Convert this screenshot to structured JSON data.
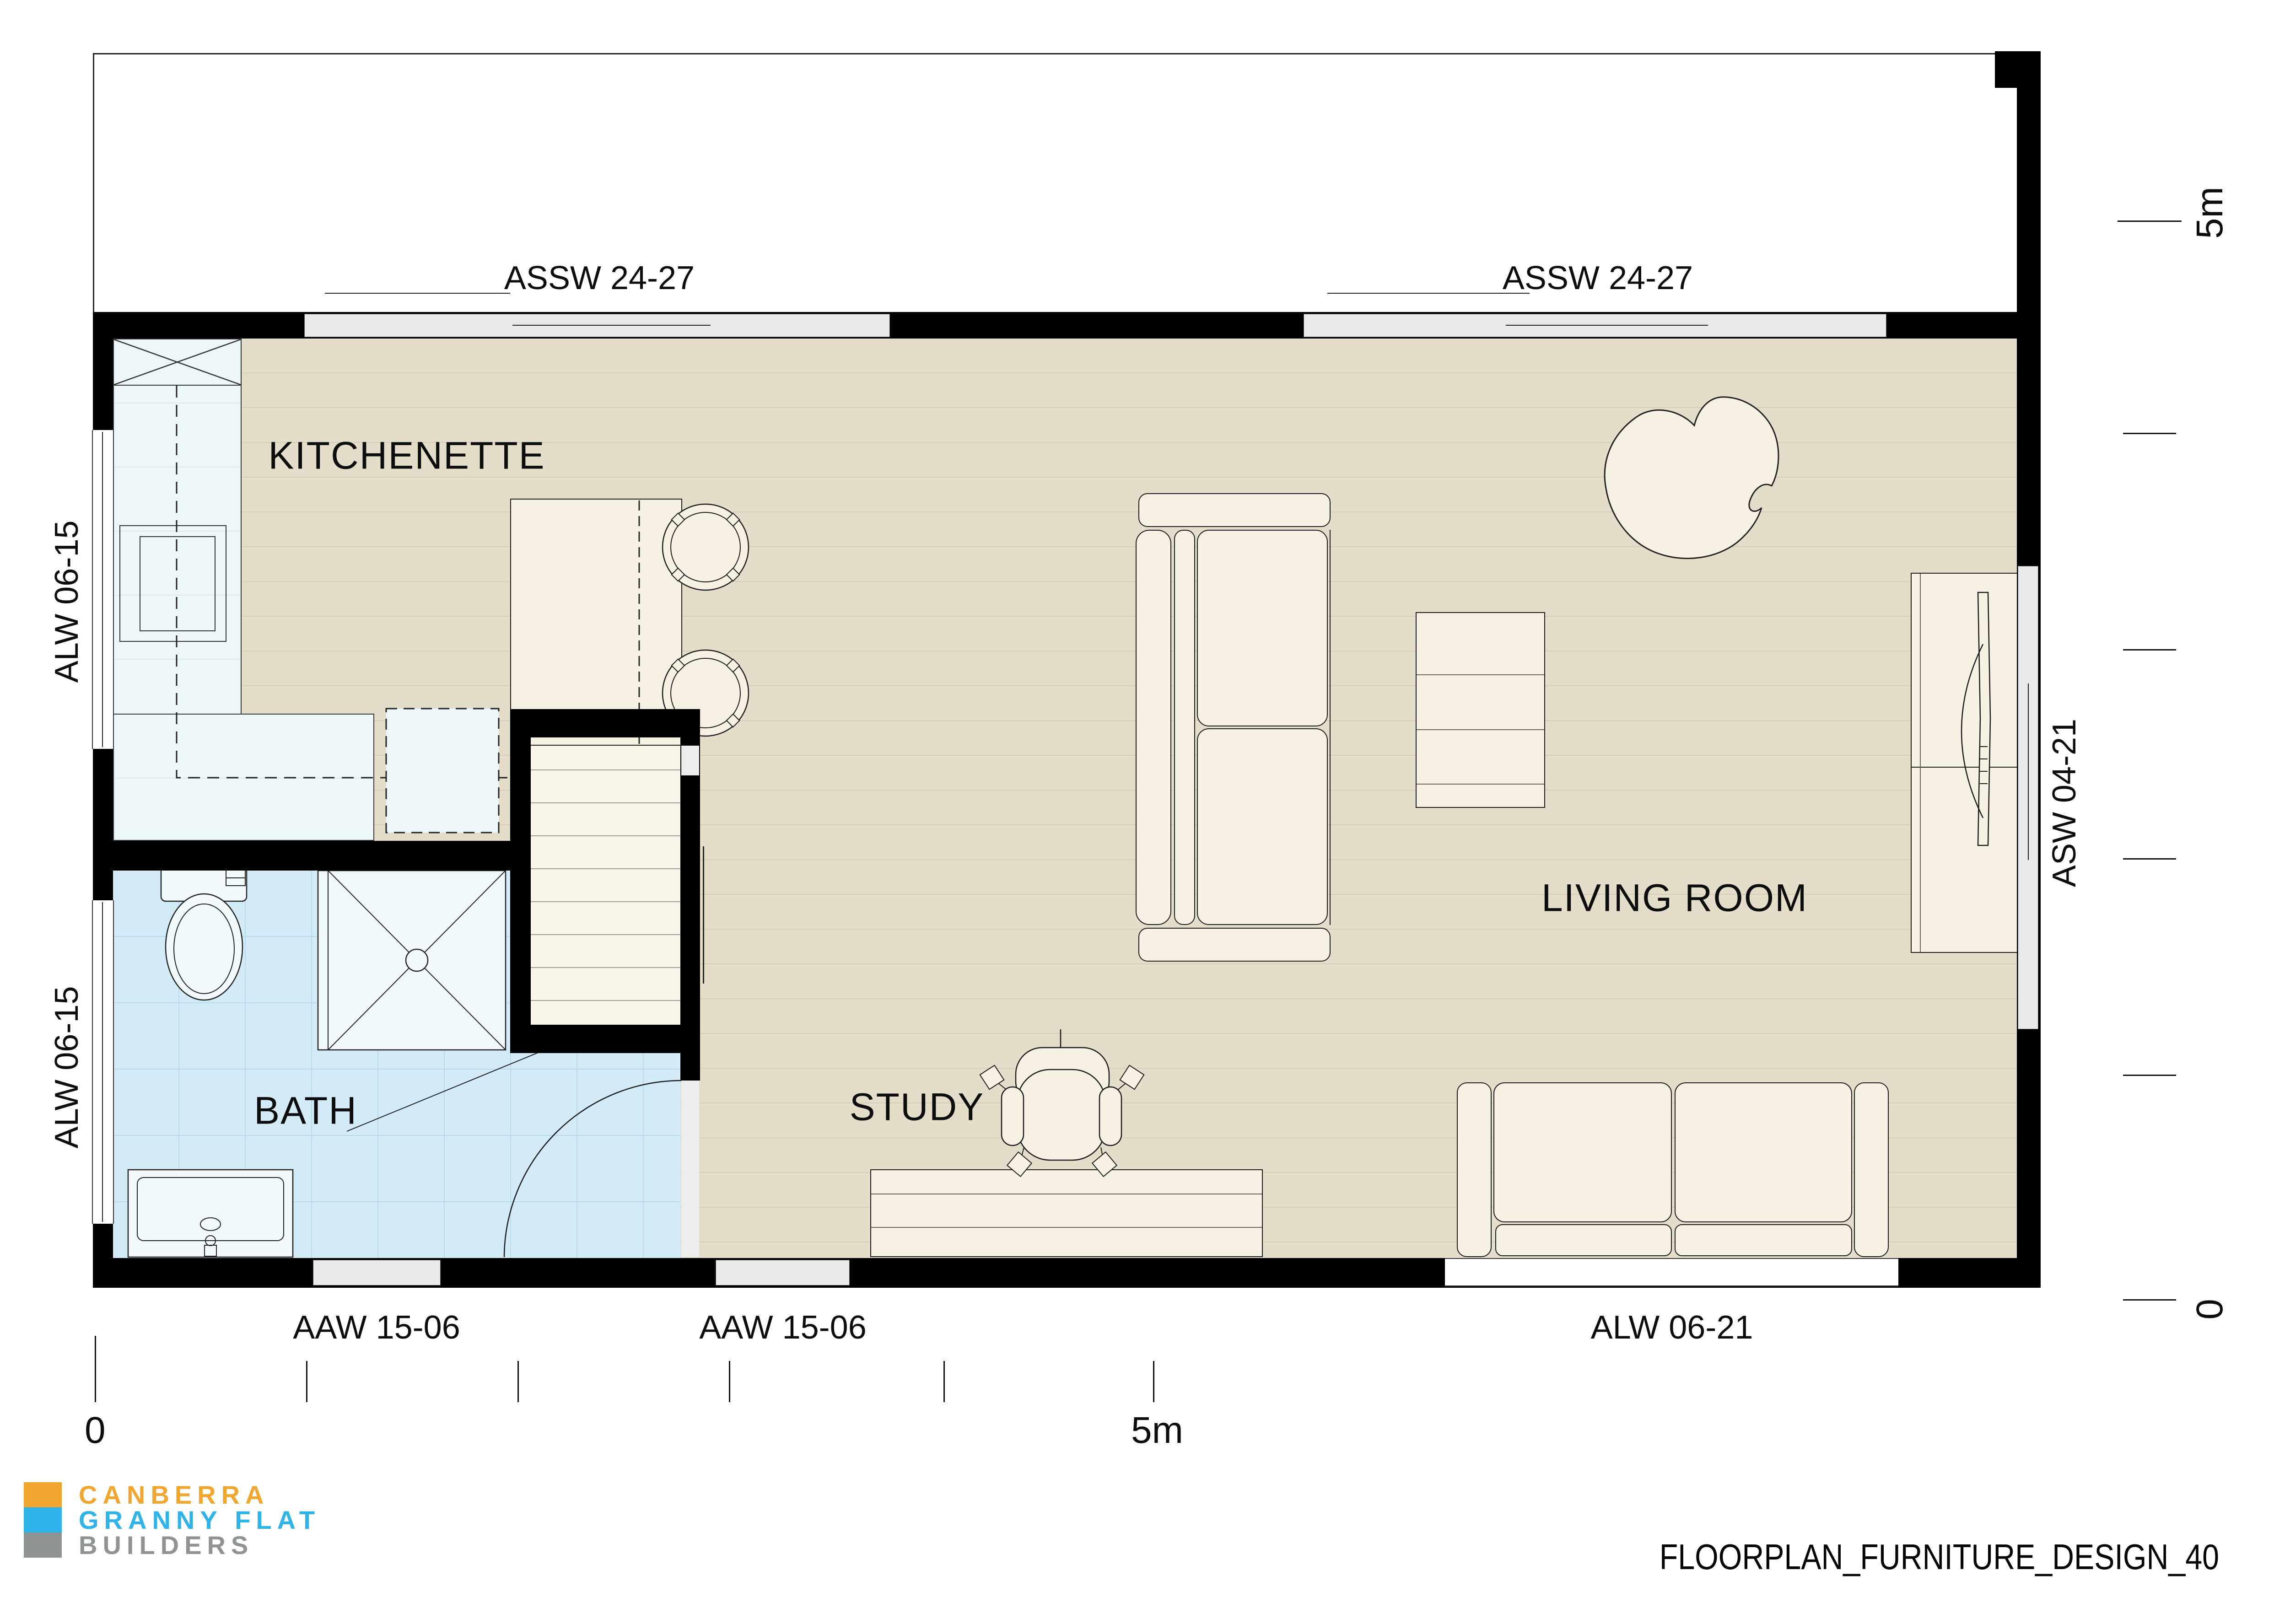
{
  "document": {
    "design_code": "FLOORPLAN_FURNITURE_DESIGN_40"
  },
  "logo": {
    "line1": "CANBERRA",
    "line2": "GRANNY FLAT",
    "line3": "BUILDERS"
  },
  "rooms": {
    "kitchenette": "KITCHENETTE",
    "living": "LIVING ROOM",
    "bath": "BATH",
    "study": "STUDY"
  },
  "windows": {
    "top_left": "ASSW 24-27",
    "top_right": "ASSW 24-27",
    "left_upper": "ALW 06-15",
    "left_lower": "ALW 06-15",
    "right": "ASW 04-21",
    "bottom_left": "AAW 15-06",
    "bottom_mid": "AAW 15-06",
    "bottom_right": "ALW 06-21"
  },
  "scale_bar": {
    "horizontal_zero": "0",
    "horizontal_max": "5m",
    "vertical_zero": "0",
    "vertical_max": "5m"
  },
  "colors": {
    "wall": "#000000",
    "floor_main": "#e4ddc9",
    "floor_plank_line": "#d5ccb6",
    "floor_bath": "#d3ebf7",
    "tile_line": "#b9dcec",
    "counter": "#edf6f9",
    "furniture": "#f6f1e2",
    "outline": "#1c1c1c",
    "window_glass": "#e9e9e9",
    "logo_orange": "#f0a62f",
    "logo_blue": "#2fb3e8",
    "logo_gray": "#8f9394"
  }
}
